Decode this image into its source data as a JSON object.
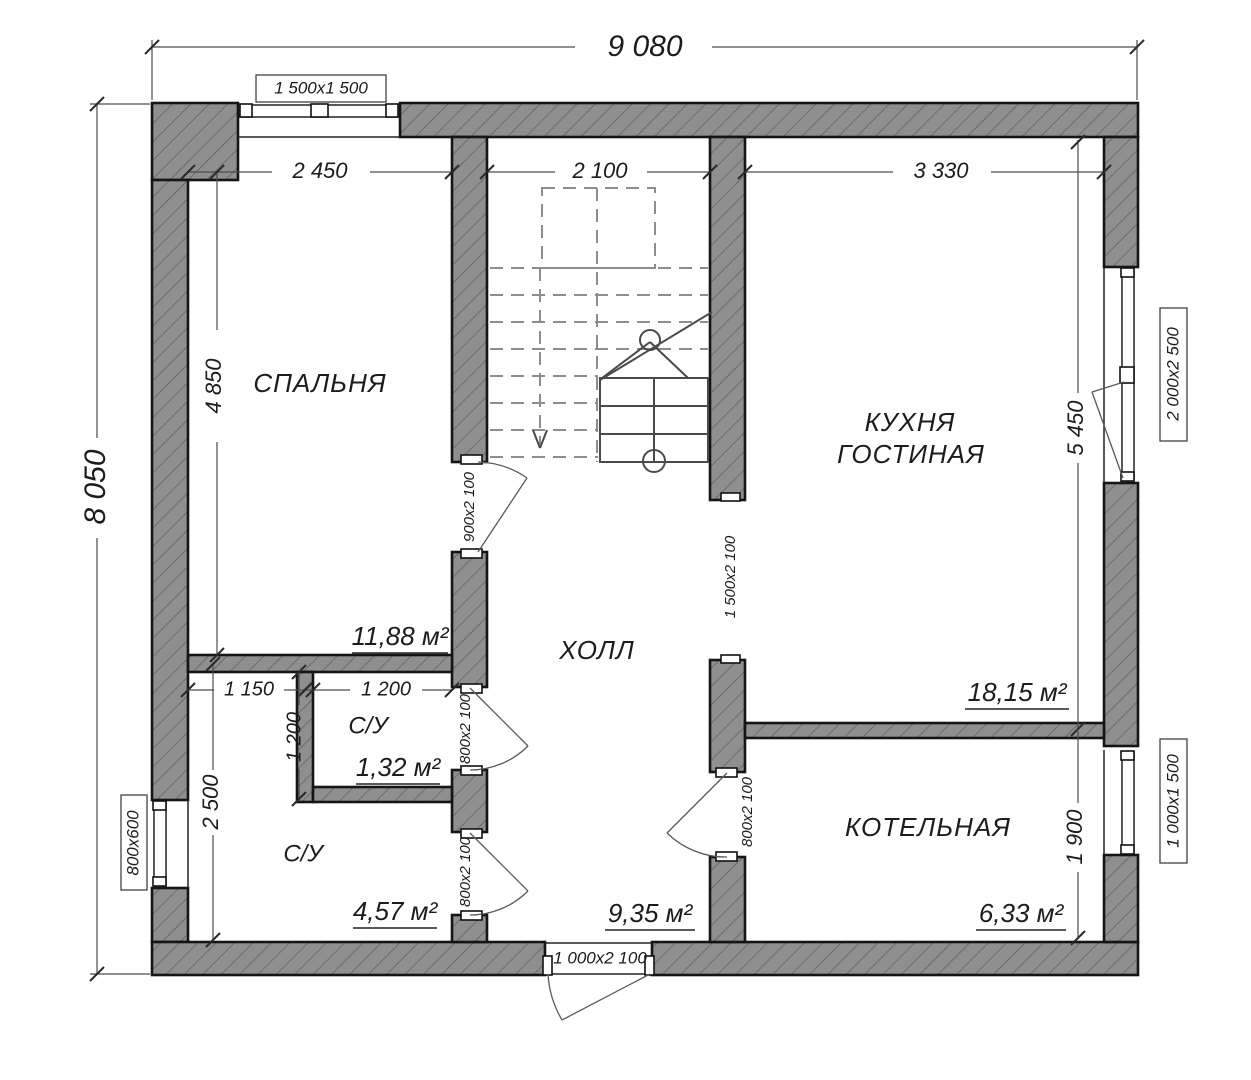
{
  "plan": {
    "dimensions": {
      "overall_width": "9 080",
      "overall_height": "8 050",
      "bedroom_width": "2 450",
      "stair_width": "2 100",
      "kitchen_width": "3 330",
      "bedroom_height": "4 850",
      "kitchen_height": "5 450",
      "boiler_height": "1 900",
      "su_left_width": "1 150",
      "su_small_width": "1 200",
      "su_small_height": "1 200",
      "su_big_height": "2 500"
    },
    "windows": {
      "top": "1 500x1 500",
      "left": "800x600",
      "kitchen": "2 000x2 500",
      "boiler": "1 000x1 500"
    },
    "doors": {
      "bedroom": "900x2 100",
      "su_small": "800x2 100",
      "su_big": "800x2 100",
      "boiler": "800x2 100",
      "kitchen_opening": "1 500x2 100",
      "entrance": "1 000x2 100"
    },
    "rooms": {
      "bedroom": {
        "label": "СПАЛЬНЯ",
        "area": "11,88 м²"
      },
      "hall": {
        "label": "ХОЛЛ",
        "area": "9,35 м²"
      },
      "kitchen": {
        "label_line1": "КУХНЯ",
        "label_line2": "ГОСТИНАЯ",
        "area": "18,15 м²"
      },
      "su_small": {
        "label": "С/У",
        "area": "1,32 м²"
      },
      "su_big": {
        "label": "С/У",
        "area": "4,57 м²"
      },
      "boiler": {
        "label": "КОТЕЛЬНАЯ",
        "area": "6,33 м²"
      }
    }
  }
}
